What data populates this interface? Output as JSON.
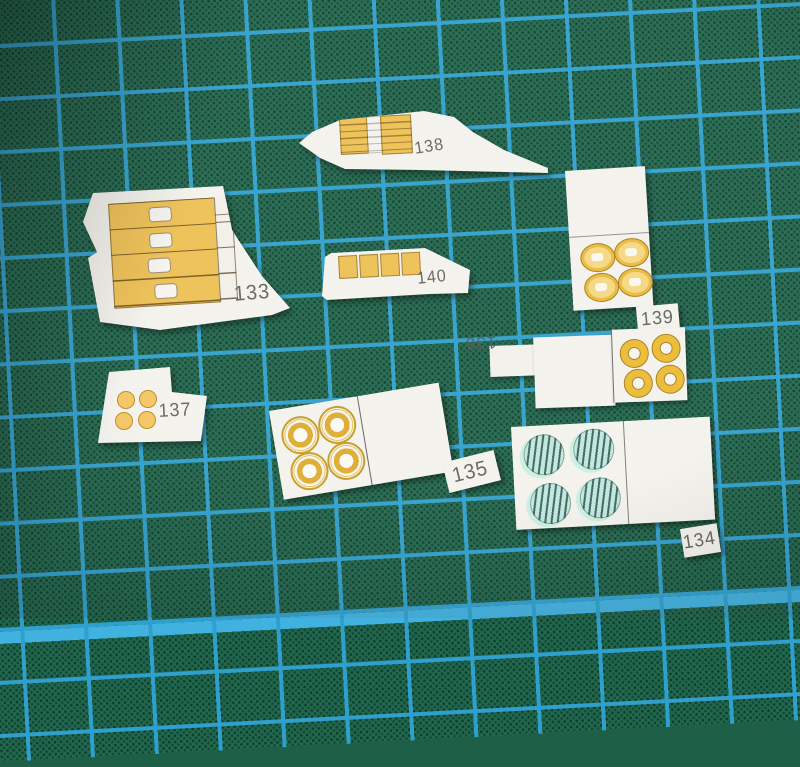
{
  "scene": {
    "subject": "Paper model cutout parts on a green cutting mat",
    "mat_base_color": "#21684e",
    "mat_grid_color": "#2f9fce",
    "mat_accent_line_color": "#41b2e0",
    "paper_color": "#f4f2ec",
    "part_yellow": "#eec052",
    "gold_ring": "#ddab30",
    "teal_circle_fill": "#bfe8de",
    "teal_circle_stripe": "#3c615b",
    "number_ink": "#575757"
  },
  "pieces": {
    "p133": {
      "label": "133"
    },
    "p134": {
      "label": "134"
    },
    "p135": {
      "label": "135"
    },
    "p136": {
      "label": "136"
    },
    "p137": {
      "label": "137"
    },
    "p138": {
      "label": "138"
    },
    "p139": {
      "label": "139"
    },
    "p140": {
      "label": "140"
    }
  }
}
